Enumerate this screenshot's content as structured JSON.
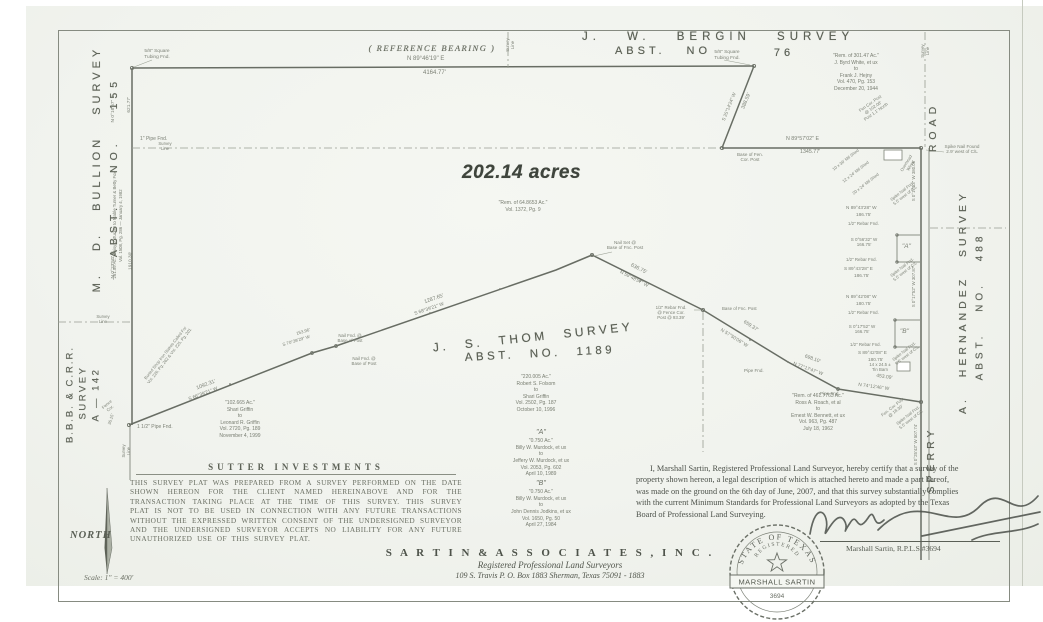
{
  "surveys": {
    "bergin": {
      "name": "J. W.  BERGIN  SURVEY",
      "abst": "ABST.  NO",
      "number": "76"
    },
    "thom": {
      "name": "J. S. THOM SURVEY",
      "abst": "ABST.  NO.  1189"
    },
    "bullion": {
      "name": "M. D.  BULLION  SURVEY",
      "abst": "ABST.  NO.  155"
    },
    "bbb": {
      "line1": "B.B.B. & C.R.R.",
      "line2": "SURVEY",
      "line3": "A — 142"
    },
    "hernandez": {
      "name": "A. HERNANDEZ  SURVEY",
      "abst": "ABST.  NO.  488"
    }
  },
  "road": {
    "upper": "ROAD",
    "lower": "SPERRY"
  },
  "reference_bearing": {
    "label": "( REFERENCE  BEARING )",
    "bearing": "N 89°46'19\" E",
    "distance": "4164.77'"
  },
  "acreage": "202.14 acres",
  "deeds": {
    "white": {
      "lines": [
        "\"Rem. of 301.47 Ac.\"",
        "J. Byrd White, et ux",
        "to",
        "Frank J. Hejny",
        "Vol. 470, Pg. 153",
        "December 20, 1944"
      ]
    },
    "remainder": {
      "lines": [
        "\"Rem. of 64.8653 Ac.\"",
        "Vol. 1372, Pg. 9"
      ]
    },
    "folsom": {
      "lines": [
        "\"220.005 Ac.\"",
        "Robert S. Folsom",
        "to",
        "Shari Griffin",
        "Vol. 2502, Pg. 187",
        "October 10, 1996"
      ]
    },
    "griffin": {
      "lines": [
        "\"102.665 Ac.\"",
        "Shari Griffin",
        "to",
        "Leonard R. Griffin",
        "Vol. 2720, Pg. 189",
        "November 4, 1999"
      ]
    },
    "murdock_a": {
      "lines": [
        "\"A\"",
        "\"0.750 Ac.\"",
        "Billy W. Murdock, et ux",
        "to",
        "Jeffery W. Murdock, et ux",
        "Vol. 2053, Pg. 602",
        "April 10, 1989"
      ]
    },
    "murdock_b": {
      "lines": [
        "\"B\"",
        "\"0.750 Ac.\"",
        "Billy W. Murdock, et ux",
        "to",
        "John Dennis Jodkins, et ux",
        "Vol. 1650, Pg. 50",
        "April 27, 1984"
      ]
    },
    "bennett": {
      "lines": [
        "\"Rem. of 461.7763 Ac.\"",
        "Ross A. Roach, et al",
        "to",
        "Ernest W. Bennett, et ux",
        "Vol. 963, Pg. 487",
        "July 18, 1962"
      ]
    },
    "tucker": {
      "lines": [
        "\"261.59 Ac.\" Daisy J. Tucker to Mable Turner & Betty Fox",
        "Vol. 1508, Pg. 286 — January 4, 1982"
      ]
    }
  },
  "sutter": {
    "client": "SUTTER  INVESTMENTS",
    "disclaimer": "THIS SURVEY PLAT WAS PREPARED FROM A SURVEY PERFORMED ON THE DATE SHOWN HEREON FOR THE CLIENT NAMED HEREINABOVE AND FOR THE TRANSACTION TAKING PLACE AT THE TIME OF THIS SURVEY. THIS SURVEY PLAT IS NOT TO BE USED IN CONNECTION WITH ANY FUTURE TRANSACTIONS WITHOUT THE EXPRESSED WRITTEN CONSENT OF THE UNDERSIGNED SURVEYOR AND THE UNDERSIGNED SURVEYOR ACCEPTS NO LIABILITY FOR ANY FUTURE UNAUTHORIZED USE OF THIS SURVEY PLAT."
  },
  "certification": {
    "lines": [
      "I, Marshall Sartin, Registered Professional Land Surveyor, hereby certify that a survey of the",
      "property shown hereon, a legal description of which is attached hereto and made a part hereof,",
      "was made on the ground on the 6th day of June, 2007, and that this survey substantially complies",
      "with the current Minimum Standards for Professional Land Surveyors as adopted by the Texas",
      "Board of Professional Land Surveying."
    ],
    "signature": "Marshall Sartin,  R.P.L.S.#3694"
  },
  "seal": {
    "arc_top": "STATE OF TEXAS",
    "arc_mid": "REGISTERED",
    "name": "MARSHALL SARTIN",
    "number": "3694"
  },
  "firm": {
    "name": "S A R T I N   &   A S S O C I A T E S ,   I N C .",
    "tagline": "Registered  Professional  Land  Surveyors",
    "address": "109 S. Travis   P. O. Box 1883        Sherman, Texas   75091 - 1883"
  },
  "compass": {
    "label": "NORTH",
    "scale": "Scale: 1\" = 400'"
  },
  "map_labels": [
    {
      "t": [
        "5/8\" Square",
        "Tubing Fnd."
      ],
      "x": 136,
      "y": 49,
      "fs": 4.8,
      "w": 42
    },
    {
      "t": [
        "5/8\" Square",
        "Tubing Fnd."
      ],
      "x": 706,
      "y": 50,
      "fs": 4.8,
      "w": 42
    },
    {
      "t": [
        "Survey",
        "Line"
      ],
      "x": 497,
      "y": 40,
      "r": -90,
      "fs": 4.3,
      "w": 26
    },
    {
      "t": "388.59'",
      "x": 738,
      "y": 98,
      "r": -68,
      "fs": 5.2
    },
    {
      "t": "S 25°14'24\" W",
      "x": 714,
      "y": 104,
      "r": -68,
      "fs": 4.7
    },
    {
      "t": "N 89°57'02\" E",
      "x": 786,
      "y": 136,
      "fs": 5.3
    },
    {
      "t": "1345.77'",
      "x": 800,
      "y": 149,
      "fs": 5.3
    },
    {
      "t": [
        "Base of Fen.",
        "Cor. Post"
      ],
      "x": 728,
      "y": 152,
      "fs": 4.6,
      "w": 44
    },
    {
      "t": [
        "Survey",
        "Line"
      ],
      "x": 912,
      "y": 46,
      "r": -90,
      "fs": 4.3,
      "w": 26
    },
    {
      "t": [
        "Spike Nail Found",
        "2.9' west of C/L"
      ],
      "x": 934,
      "y": 144,
      "fs": 4.6,
      "w": 56
    },
    {
      "t": [
        "Fen Cor. Post",
        "@ 102.08'",
        "Post 1.1' North"
      ],
      "x": 852,
      "y": 100,
      "r": -35,
      "fs": 4.3,
      "w": 42
    },
    {
      "t": "N 0°16'57\" E",
      "x": 100,
      "y": 106,
      "r": -90,
      "fs": 4.8
    },
    {
      "t": "621.77'",
      "x": 122,
      "y": 102,
      "r": -90,
      "fs": 4.8
    },
    {
      "t": "1\" Pipe Fnd.",
      "x": 140,
      "y": 137,
      "fs": 5
    },
    {
      "t": [
        "Survey",
        "Line"
      ],
      "x": 152,
      "y": 141,
      "fs": 4.3,
      "w": 26
    },
    {
      "t": [
        "Survey",
        "Line"
      ],
      "x": 90,
      "y": 314,
      "fs": 4.3,
      "w": 26
    },
    {
      "t": "N 0°23'50\" E",
      "x": 100,
      "y": 262,
      "r": -90,
      "fs": 4.8
    },
    {
      "t": "1910.30'",
      "x": 122,
      "y": 258,
      "r": -90,
      "fs": 4.8
    },
    {
      "t": "1 1/2\" Pipe Fnd.",
      "x": 137,
      "y": 425,
      "fs": 5
    },
    {
      "t": [
        "Fence",
        "Cor."
      ],
      "x": 98,
      "y": 402,
      "r": -40,
      "fs": 4.2,
      "w": 22
    },
    {
      "t": "36.15'",
      "x": 106,
      "y": 417,
      "r": -72,
      "fs": 4.2
    },
    {
      "t": [
        "Survey",
        "Line"
      ],
      "x": 114,
      "y": 446,
      "r": -90,
      "fs": 4.2,
      "w": 26
    },
    {
      "t": [
        "Buried Shop Iron Stakes Called For",
        "Vol. 226, Pg. 262 & Vol. 225, Pg. 201"
      ],
      "x": 104,
      "y": 350,
      "r": -52,
      "fs": 4.2,
      "w": 128
    },
    {
      "t": "1092.31'",
      "x": 196,
      "y": 382,
      "r": -21,
      "fs": 5.3
    },
    {
      "t": "S 66°39'21\" W",
      "x": 188,
      "y": 392,
      "r": -21,
      "fs": 4.8
    },
    {
      "t": [
        "Nail Fnd. @",
        "Base of Post"
      ],
      "x": 330,
      "y": 333,
      "fs": 4.4,
      "w": 40
    },
    {
      "t": [
        "Nail Fnd. @",
        "Base of Post"
      ],
      "x": 344,
      "y": 356,
      "fs": 4.4,
      "w": 40
    },
    {
      "t": "S 70°39'29\" W",
      "x": 282,
      "y": 338,
      "r": -17,
      "fs": 4.4
    },
    {
      "t": "153.96'",
      "x": 296,
      "y": 329,
      "r": -17,
      "fs": 4.4
    },
    {
      "t": "1287.65'",
      "x": 424,
      "y": 296,
      "r": -19,
      "fs": 5.3
    },
    {
      "t": "S 68°39'21\" W",
      "x": 414,
      "y": 307,
      "r": -19,
      "fs": 4.8
    },
    {
      "t": [
        "Nail Set @",
        "Base of Fnc. Post"
      ],
      "x": 598,
      "y": 240,
      "fs": 4.6,
      "w": 54
    },
    {
      "t": "636.75'",
      "x": 630,
      "y": 266,
      "r": 27,
      "fs": 5.3
    },
    {
      "t": "N 59°48'57\" W",
      "x": 618,
      "y": 277,
      "r": 27,
      "fs": 4.8
    },
    {
      "t": [
        "1/2\" Rebar Fnd.",
        "@ Fence Cor.",
        "Post @ 93.39'"
      ],
      "x": 648,
      "y": 305,
      "fs": 4.4,
      "w": 46
    },
    {
      "t": "Base of Fnc. Post",
      "x": 722,
      "y": 306,
      "fs": 4.4
    },
    {
      "t": "659.37'",
      "x": 742,
      "y": 324,
      "r": 32,
      "fs": 5
    },
    {
      "t": "N 57°50'06\" W",
      "x": 718,
      "y": 336,
      "r": 32,
      "fs": 4.8
    },
    {
      "t": "698.10'",
      "x": 804,
      "y": 357,
      "r": 20,
      "fs": 5
    },
    {
      "t": "N 77°17'47\" W",
      "x": 792,
      "y": 367,
      "r": 20,
      "fs": 4.8
    },
    {
      "t": "Pipe Fnd.",
      "x": 744,
      "y": 368,
      "fs": 4.6
    },
    {
      "t": "Pipe Fnd.",
      "x": 820,
      "y": 391,
      "fs": 4.6
    },
    {
      "t": "453.09'",
      "x": 876,
      "y": 375,
      "r": 8,
      "fs": 5
    },
    {
      "t": "N 74°12'46\" W",
      "x": 858,
      "y": 385,
      "r": 8,
      "fs": 4.8
    },
    {
      "t": [
        "Fen. Cor. Post",
        "@ 18.30'"
      ],
      "x": 872,
      "y": 404,
      "r": -38,
      "fs": 4.3,
      "w": 44
    },
    {
      "t": "N 89°43'28\" W",
      "x": 846,
      "y": 205,
      "fs": 4.7
    },
    {
      "t": "186.75'",
      "x": 856,
      "y": 212,
      "fs": 4.7
    },
    {
      "t": "1/2\" Rebar Fnd.",
      "x": 848,
      "y": 221,
      "fs": 4.4
    },
    {
      "t": [
        "S 0°56'32\" W",
        "166.75'"
      ],
      "x": 842,
      "y": 237,
      "fs": 4.5,
      "w": 44
    },
    {
      "t": "1/2\" Rebar Fnd.",
      "x": 846,
      "y": 257,
      "fs": 4.4
    },
    {
      "t": "S 89°43'28\" E",
      "x": 844,
      "y": 266,
      "fs": 4.7
    },
    {
      "t": "186.75'",
      "x": 854,
      "y": 273,
      "fs": 4.7
    },
    {
      "t": "\"A\"",
      "x": 902,
      "y": 243,
      "fs": 6.5,
      "it": 1
    },
    {
      "t": "\"B\"",
      "x": 900,
      "y": 328,
      "fs": 6.5,
      "it": 1
    },
    {
      "t": "N 89°42'08\" W",
      "x": 846,
      "y": 294,
      "fs": 4.7
    },
    {
      "t": "180.75'",
      "x": 856,
      "y": 301,
      "fs": 4.7
    },
    {
      "t": "1/2\" Rebar Fnd.",
      "x": 848,
      "y": 310,
      "fs": 4.4
    },
    {
      "t": [
        "S 0°17'52\" W",
        "166.75'"
      ],
      "x": 840,
      "y": 324,
      "fs": 4.5,
      "w": 44
    },
    {
      "t": "1/2\" Rebar Fnd.",
      "x": 850,
      "y": 342,
      "fs": 4.4
    },
    {
      "t": "S 89°42'08\" E",
      "x": 858,
      "y": 350,
      "fs": 4.7
    },
    {
      "t": "180.75'",
      "x": 868,
      "y": 357,
      "fs": 4.7
    },
    {
      "t": [
        "14 x 24.5 ±",
        "Tin Barn"
      ],
      "x": 862,
      "y": 362,
      "fs": 4.3,
      "w": 36
    },
    {
      "t": [
        "Spike Nail Fnd.",
        "5.5' west of C/L"
      ],
      "x": 880,
      "y": 189,
      "r": -38,
      "fs": 4.2,
      "w": 48
    },
    {
      "t": [
        "Spike Nail Fnd.",
        "5.5' west of C/L"
      ],
      "x": 880,
      "y": 265,
      "r": -38,
      "fs": 4.2,
      "w": 48
    },
    {
      "t": [
        "Spike Nail Fnd.",
        "5.5' west of C/L"
      ],
      "x": 882,
      "y": 349,
      "r": -38,
      "fs": 4.2,
      "w": 48
    },
    {
      "t": [
        "Spike Nail Fnd.",
        "5.5' west of C/L"
      ],
      "x": 886,
      "y": 413,
      "r": -38,
      "fs": 4.2,
      "w": 48
    },
    {
      "t": "S 0°17'53\" W  380.06'",
      "x": 893,
      "y": 178,
      "r": -90,
      "fs": 4.4
    },
    {
      "t": "S 0°17'52\" W  307.87'",
      "x": 893,
      "y": 284,
      "r": -90,
      "fs": 4.4
    },
    {
      "t": "S 0°25'43\" W  507.74'",
      "x": 895,
      "y": 442,
      "r": -90,
      "fs": 4.4
    },
    {
      "t": "10 x 36' Mtl Shed",
      "x": 830,
      "y": 158,
      "r": -38,
      "fs": 4.2
    },
    {
      "t": "12 x 24' Mtl Shed",
      "x": 840,
      "y": 170,
      "r": -38,
      "fs": 4.2
    },
    {
      "t": "20 x 24' Mtl Shed",
      "x": 850,
      "y": 182,
      "r": -38,
      "fs": 4.2
    },
    {
      "t": [
        "Overhead",
        "Wires"
      ],
      "x": 893,
      "y": 160,
      "r": -58,
      "fs": 4.2,
      "w": 32
    }
  ]
}
